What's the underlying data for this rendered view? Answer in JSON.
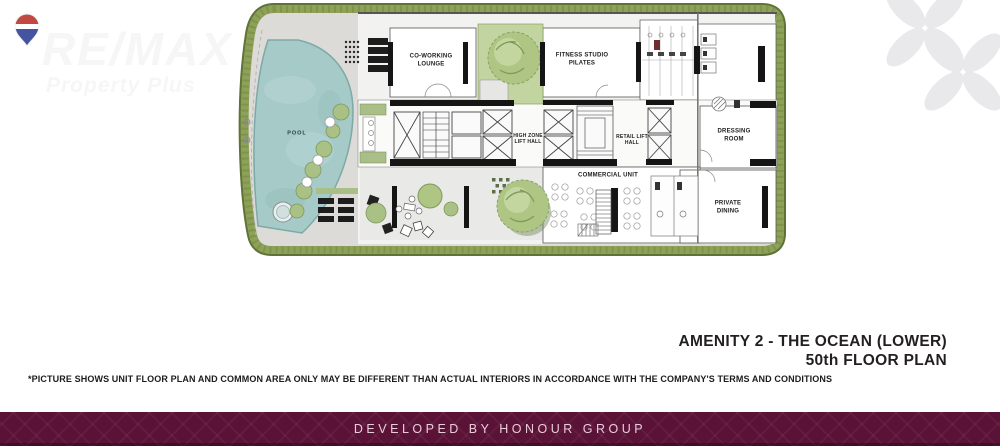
{
  "logo": {
    "brand": "RE/MAX",
    "subtitle": "Property Plus"
  },
  "watermark": {
    "motif": "petal-flower"
  },
  "plan": {
    "rooms": {
      "pool": "POOL",
      "coworking": "CO-WORKING LOUNGE",
      "fitness": "FITNESS STUDIO PILATES",
      "high_zone_lift": "HIGH ZONE LIFT HALL",
      "retail_lift": "RETAIL LIFT HALL",
      "commercial": "COMMERCIAL UNIT",
      "dressing": "DRESSING ROOM",
      "private_dining": "PRIVATE DINING"
    }
  },
  "title": {
    "line1": "AMENITY 2 - THE OCEAN (LOWER)",
    "line2": "50th FLOOR PLAN"
  },
  "disclaimer": "*PICTURE SHOWS UNIT FLOOR PLAN AND COMMON AREA ONLY MAY BE DIFFERENT THAN ACTUAL INTERIORS IN ACCORDANCE WITH THE COMPANY'S TERMS AND CONDITIONS",
  "footer": {
    "text": "DEVELOPED BY HONOUR GROUP"
  },
  "colors": {
    "footer_bg": "#5a1237",
    "footer_text": "#e9cdda",
    "hedge": "#8da159",
    "pool": "#a6cac8",
    "title_text": "#231f20",
    "watermark": "#e9e9ec",
    "balloon_red": "#c24941",
    "balloon_blue": "#44549e"
  }
}
